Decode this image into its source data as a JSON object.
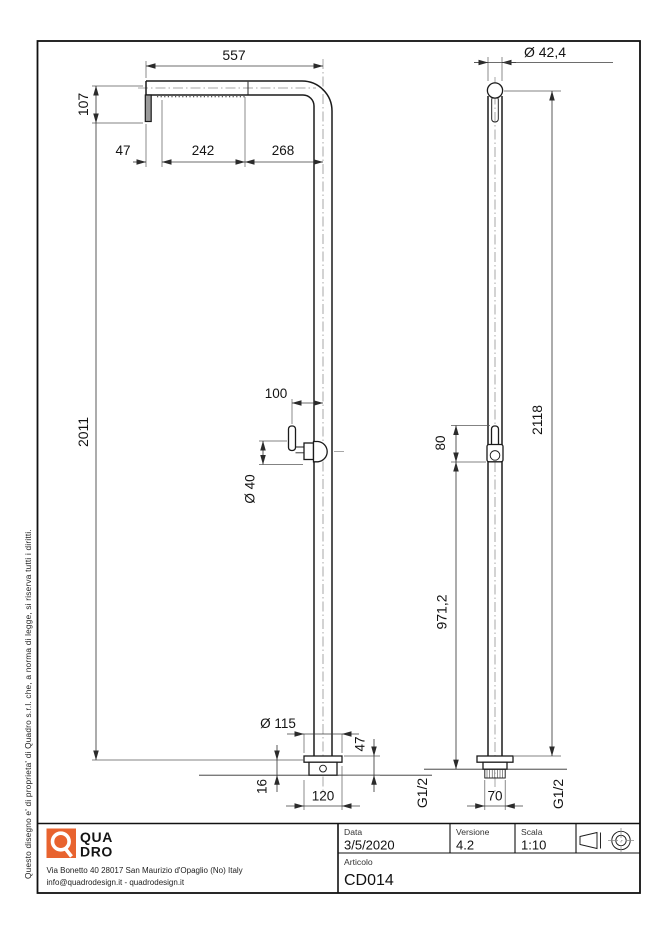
{
  "disclaimer": "Questo disegno e' di proprieta' di Quadro s.r.l. che, a norma di legge, si riserva tutti i diritti.",
  "brand": {
    "q": "Q",
    "name_line1": "QUA",
    "name_line2": "DRO",
    "address": "Via Bonetto 40  28017 San Maurizio d'Opaglio (No) Italy",
    "contacts": "info@quadrodesign.it  -  quadrodesign.it",
    "color": "#E8632F"
  },
  "title_block": {
    "date_label": "Data",
    "date_value": "3/5/2020",
    "version_label": "Versione",
    "version_value": "4.2",
    "scale_label": "Scala",
    "scale_value": "1:10",
    "article_label": "Articolo",
    "article_value": "CD014"
  },
  "front_view": {
    "arm_length": "557",
    "head_drop": "107",
    "seg_47": "47",
    "seg_242": "242",
    "seg_268": "268",
    "column_height": "2011",
    "handle_reach": "100",
    "handle_dia": "Ø 40",
    "base_dia": "Ø 115",
    "base_h": "47",
    "plate_h": "16",
    "base_w": "120"
  },
  "side_view": {
    "tube_dia": "Ø 42,4",
    "total_height": "2118",
    "handle_len": "80",
    "handle_height": "971,2",
    "thread_left": "G1/2",
    "thread_size": "70",
    "thread_right": "G1/2"
  }
}
